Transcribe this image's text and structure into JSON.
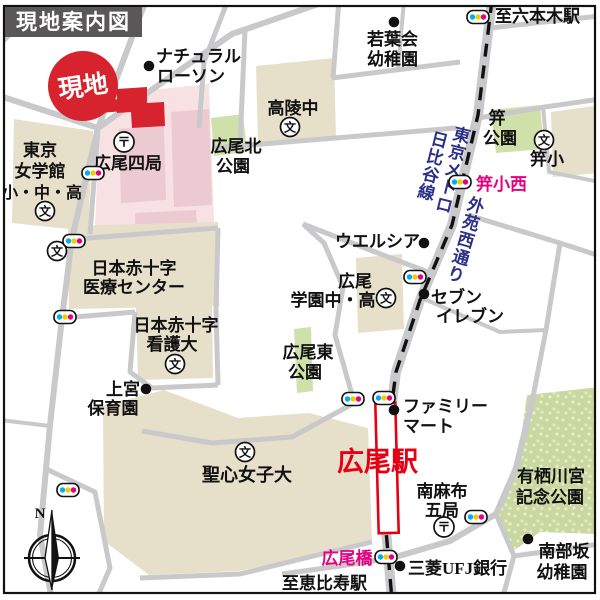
{
  "title": "現地案内図",
  "colors": {
    "red": "#d7232d",
    "station_red": "#e60012",
    "magenta": "#e4007f",
    "navy": "#2c2f88",
    "road": "#c9c9cb",
    "beige": "#e6dfc9",
    "pink_zone": "#f7e1e3",
    "pink_bldg": "#eccad1",
    "park": "#cfe0ab",
    "park_dark": "#c8d8a0",
    "park_dot": "#e3edc6",
    "title_bg": "#595757",
    "black": "#111111"
  },
  "map": {
    "school_glyph": "文",
    "post_glyph": "〒",
    "light_colors": [
      "#00aeef",
      "#f5cc00",
      "#e4007f"
    ],
    "parks": [
      {
        "n": "hiroo-kita-park",
        "pts": "211,118 243,114 247,152 214,156"
      },
      {
        "n": "kogai-park",
        "pts": "491,110 540,105 544,149 496,153"
      },
      {
        "n": "hiroo-higashi-park",
        "pts": "294,329 311,327 313,391 297,393"
      },
      {
        "n": "arisugawa-park",
        "tex": 1,
        "pts": "527,395 600,387 600,534 540,532 512,552 495,514 517,466"
      }
    ],
    "pink_zone": "99,130 151,90 209,84 215,248 94,253",
    "pink_buildings": [
      "119,129 164,126 166,200 121,203",
      "171,112 209,109 212,205 174,207",
      "135,213 196,210 198,247 136,249"
    ],
    "buildings": [
      {
        "n": "tokyo-joshigakkan",
        "pts": "14,119 93,131 88,231 12,223"
      },
      {
        "n": "koryo-junior-high",
        "pts": "256,66 334,58 336,136 258,144"
      },
      {
        "n": "kogai-elementary",
        "pts": "551,112 600,105 600,173 553,177"
      },
      {
        "n": "redcross-medical-center",
        "pts": "68,226 218,222 219,306 69,309"
      },
      {
        "n": "redcross-nursing-univ",
        "pts": "136,307 212,305 213,378 138,380"
      },
      {
        "n": "hiroo-gakuen",
        "pts": "356,258 402,254 404,329 358,333"
      },
      {
        "n": "seishin-univ-campus",
        "pts": "103,406 164,390 238,418 309,413 368,428 372,540 330,551 239,571 149,575 104,541"
      }
    ],
    "roads": [
      [
        "M146,0 L98,128 L72,238 L62,318 L50,425 L40,535 L52,600",
        6
      ],
      [
        "M0,96 L98,128",
        6
      ],
      [
        "M0,44 L46,0",
        5
      ],
      [
        "M98,128 L160,84 L232,34 L330,0",
        6
      ],
      [
        "M228,0 L204,62 L199,128",
        5
      ],
      [
        "M98,128 L90,234",
        5
      ],
      [
        "M63,240 L218,228",
        5
      ],
      [
        "M62,318 L135,312",
        5
      ],
      [
        "M135,312 L130,372 L152,388 L218,385",
        5
      ],
      [
        "M218,228 L216,310 L218,385",
        5
      ],
      [
        "M356,402 L292,437 L212,443 L142,431",
        5
      ],
      [
        "M44,468 L95,492 L110,568 L96,600",
        5
      ],
      [
        "M0,420 L50,426",
        4
      ],
      [
        "M492,0 L478,115 L452,225 L420,300 L396,372 L389,425 L386,530 L392,600",
        10
      ],
      [
        "M490,28 L600,16",
        5
      ],
      [
        "M332,78 L460,62",
        5
      ],
      [
        "M339,0 L333,78",
        5
      ],
      [
        "M404,0 L398,70",
        4
      ],
      [
        "M215,148 L456,128",
        5
      ],
      [
        "M245,30 L240,145",
        5
      ],
      [
        "M478,118 L545,107 L600,99",
        5
      ],
      [
        "M543,106 L549,172 L600,182",
        4
      ],
      [
        "M468,215 L560,243 L600,256",
        5
      ],
      [
        "M560,243 L546,330 L533,397",
        5
      ],
      [
        "M422,298 L500,332 L546,330",
        4
      ],
      [
        "M353,398 L335,335 L343,287 L324,243 L303,224",
        5
      ],
      [
        "M303,224 L370,250 L428,272",
        5
      ],
      [
        "M533,397 L516,468 L496,514 L450,541 L392,558",
        6
      ],
      [
        "M496,514 L514,556 L502,600",
        5
      ],
      [
        "M514,556 L600,544",
        5
      ],
      [
        "M392,558 L340,566 L282,574",
        5
      ],
      [
        "M140,578 L240,574 L330,552 L372,542",
        5
      ]
    ],
    "metro_line": "M492,0 L478,115 L452,225 L420,300 L396,372 L389,425 L386,530 L392,600",
    "station": {
      "x": 377,
      "y": 403,
      "w": 20,
      "h": 130,
      "rot": -1.5
    },
    "site_building": "117,89 147,87 147,103 164,102 165,126 132,128 131,112 117,113",
    "site_marker": {
      "cx": 83,
      "cy": 86,
      "r": 35,
      "rot": -8,
      "label": "現地",
      "tail": "99,113 116,99 137,110"
    },
    "labels": [
      {
        "t": "ナチュラル",
        "x": 156,
        "y": 62,
        "a": "start"
      },
      {
        "t": "ローソン",
        "x": 157,
        "y": 82,
        "a": "start"
      },
      {
        "t": "若葉会",
        "x": 367,
        "y": 45,
        "a": "start"
      },
      {
        "t": "幼稚園",
        "x": 367,
        "y": 65,
        "a": "start"
      },
      {
        "t": "至六本木駅",
        "x": 495,
        "y": 22,
        "a": "start"
      },
      {
        "t": "高陵中",
        "x": 293,
        "y": 114
      },
      {
        "t": "広尾北",
        "x": 236,
        "y": 152
      },
      {
        "t": "公園",
        "x": 233,
        "y": 172
      },
      {
        "t": "笄",
        "x": 497,
        "y": 124
      },
      {
        "t": "公園",
        "x": 500,
        "y": 144
      },
      {
        "t": "笄小",
        "x": 547,
        "y": 165
      },
      {
        "t": "笄小西",
        "x": 476,
        "y": 190,
        "a": "start",
        "c": "magenta"
      },
      {
        "t": "ウエルシア",
        "x": 335,
        "y": 247,
        "a": "start"
      },
      {
        "t": "広尾",
        "x": 355,
        "y": 287
      },
      {
        "t": "学園中・高",
        "x": 333,
        "y": 306
      },
      {
        "t": "セブン",
        "x": 431,
        "y": 303,
        "a": "start"
      },
      {
        "t": "イレブン",
        "x": 436,
        "y": 322,
        "a": "start"
      },
      {
        "t": "日本赤十字",
        "x": 134,
        "y": 274
      },
      {
        "t": "医療センター",
        "x": 134,
        "y": 293
      },
      {
        "t": "日本赤十字",
        "x": 176,
        "y": 331
      },
      {
        "t": "看護大",
        "x": 172,
        "y": 350
      },
      {
        "t": "広尾東",
        "x": 308,
        "y": 358
      },
      {
        "t": "公園",
        "x": 305,
        "y": 378
      },
      {
        "t": "上宮",
        "x": 123,
        "y": 395
      },
      {
        "t": "保育園",
        "x": 113,
        "y": 414
      },
      {
        "t": "聖心女子大",
        "x": 247,
        "y": 481,
        "s": 18
      },
      {
        "t": "ファミリー",
        "x": 403,
        "y": 412,
        "a": "start"
      },
      {
        "t": "マート",
        "x": 403,
        "y": 432,
        "a": "start"
      },
      {
        "t": "広尾駅",
        "x": 337,
        "y": 471,
        "a": "start",
        "s": 27,
        "c": "station_red",
        "b": 1
      },
      {
        "t": "南麻布",
        "x": 442,
        "y": 497
      },
      {
        "t": "五局",
        "x": 442,
        "y": 516
      },
      {
        "t": "有栖川宮",
        "x": 551,
        "y": 482
      },
      {
        "t": "記念公園",
        "x": 550,
        "y": 503
      },
      {
        "t": "南部坂",
        "x": 564,
        "y": 557
      },
      {
        "t": "幼稚園",
        "x": 562,
        "y": 578
      },
      {
        "t": "広尾橋",
        "x": 347,
        "y": 564,
        "c": "magenta"
      },
      {
        "t": "三菱UFJ銀行",
        "x": 408,
        "y": 574,
        "a": "start"
      },
      {
        "t": "至恵比寿駅",
        "x": 282,
        "y": 589,
        "a": "start"
      },
      {
        "t": "広尾四局",
        "x": 128,
        "y": 169
      },
      {
        "t": "東京",
        "x": 40,
        "y": 156
      },
      {
        "t": "女学館",
        "x": 40,
        "y": 177
      },
      {
        "t": "小・中・高",
        "x": 42,
        "y": 198,
        "s": 16
      }
    ],
    "vertical_labels": [
      {
        "t": "東京メトロ",
        "x": 453,
        "y": 170,
        "r": 14,
        "c": "navy"
      },
      {
        "t": "日比谷線",
        "x": 433,
        "y": 166,
        "r": 14,
        "c": "navy"
      },
      {
        "t": "外苑西通り",
        "x": 466,
        "y": 240,
        "r": 16,
        "c": "navy"
      }
    ],
    "poi_dots": [
      [
        149,
        66
      ],
      [
        394,
        22
      ],
      [
        424,
        243
      ],
      [
        424,
        294
      ],
      [
        146,
        389
      ],
      [
        394,
        410
      ],
      [
        400,
        566
      ],
      [
        528,
        539
      ]
    ],
    "school_icons": [
      [
        290,
        127
      ],
      [
        45,
        211
      ],
      [
        57,
        251
      ],
      [
        544,
        140
      ],
      [
        386,
        298
      ],
      [
        175,
        364
      ],
      [
        245,
        452
      ]
    ],
    "post_icons": [
      [
        124,
        142
      ],
      [
        444,
        527
      ]
    ],
    "traffic_lights": [
      [
        93,
        173
      ],
      [
        74,
        241
      ],
      [
        65,
        317
      ],
      [
        68,
        490
      ],
      [
        478,
        17
      ],
      [
        460,
        182
      ],
      [
        415,
        277
      ],
      [
        353,
        399
      ],
      [
        384,
        398
      ],
      [
        476,
        517
      ],
      [
        386,
        557
      ]
    ],
    "compass": {
      "cx": 52,
      "cy": 558,
      "n": "N"
    }
  }
}
